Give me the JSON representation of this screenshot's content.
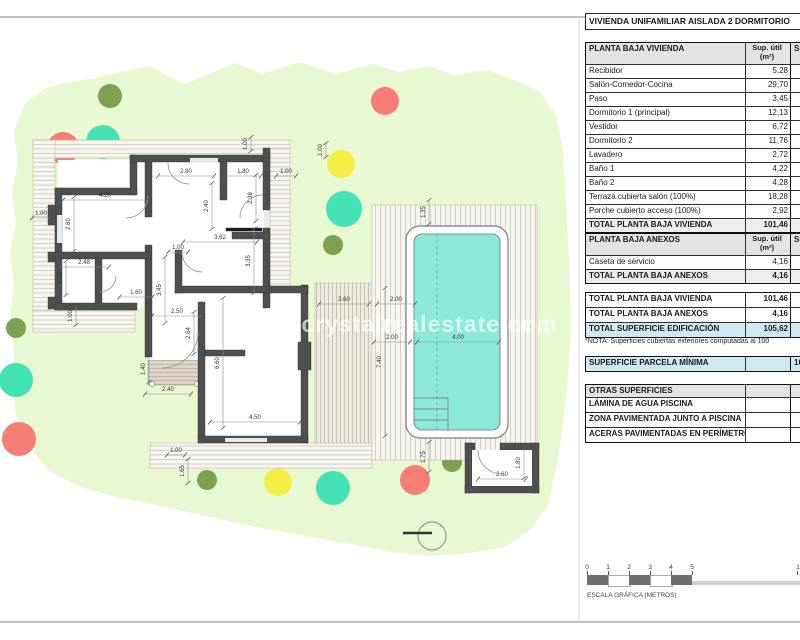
{
  "sheet": {
    "title": "VIVIENDA UNIFAMILIAR AISLADA 2 DORMITORIO",
    "watermark": "www.crystalrealestate.com",
    "nota": "*NOTA: Superficies cubiertas exteriores computadas al 100",
    "colors": {
      "garden": "#e8f8d2",
      "wall": "#4f4f4f",
      "water": "#8ce9da",
      "blue_row": "#cfe9f1",
      "header_row": "#e3e3e3",
      "tree_olive": "#7fa051",
      "tree_red": "#f77d77",
      "tree_teal": "#43e3b5",
      "tree_yellow": "#f2ee45"
    }
  },
  "tables": {
    "vivienda": {
      "rows": [
        {
          "l": "PLANTA BAJA VIVIENDA",
          "v": "Sup. útil\n(m²)",
          "e": "Sup",
          "c": "head"
        },
        {
          "l": "Recibidor",
          "v": "5,28",
          "e": "",
          "c": ""
        },
        {
          "l": "Salón-Comedor-Cocina",
          "v": "29,70",
          "e": "",
          "c": ""
        },
        {
          "l": "Paso",
          "v": "3,45",
          "e": "",
          "c": ""
        },
        {
          "l": "Dormitorio 1 (principal)",
          "v": "12,13",
          "e": "",
          "c": ""
        },
        {
          "l": "Vestidor",
          "v": "6,72",
          "e": "",
          "c": ""
        },
        {
          "l": "Dormitorio 2",
          "v": "11,76",
          "e": "",
          "c": ""
        },
        {
          "l": "Lavadero",
          "v": "2,72",
          "e": "",
          "c": ""
        },
        {
          "l": "Baño 1",
          "v": "4,22",
          "e": "",
          "c": ""
        },
        {
          "l": "Baño 2",
          "v": "4,28",
          "e": "",
          "c": ""
        },
        {
          "l": "Terraza cubierta salón (100%)",
          "v": "18,28",
          "e": "",
          "c": ""
        },
        {
          "l": "Porche cubierto acceso (100%)",
          "v": "2,92",
          "e": "",
          "c": ""
        },
        {
          "l": "TOTAL PLANTA BAJA VIVIENDA",
          "v": "101,46",
          "e": "",
          "c": "total"
        }
      ]
    },
    "anexos": {
      "rows": [
        {
          "l": "PLANTA BAJA ANEXOS",
          "v": "Sup. útil\n(m²)",
          "e": "Sup",
          "c": "head"
        },
        {
          "l": "Caseta de servicio",
          "v": "4,16",
          "e": "",
          "c": ""
        },
        {
          "l": "TOTAL PLANTA BAJA ANEXOS",
          "v": "4,16",
          "e": "",
          "c": "total"
        }
      ]
    },
    "resumen": {
      "rows": [
        {
          "l": "TOTAL PLANTA BAJA VIVIENDA",
          "v": "101,46",
          "e": "",
          "c": "sum"
        },
        {
          "l": "TOTAL PLANTA BAJA ANEXOS",
          "v": "4,16",
          "e": "",
          "c": "sum"
        },
        {
          "l": "TOTAL SUPERFICIE EDIFICACIÓN",
          "v": "105,62",
          "e": "",
          "c": "blue"
        }
      ]
    },
    "parcela": {
      "rows": [
        {
          "l": "SUPERFICIE PARCELA MÍNIMA",
          "v": "",
          "e": "10",
          "c": "blue"
        }
      ]
    },
    "otras": {
      "rows": [
        {
          "l": "OTRAS SUPERFICIES",
          "v": "",
          "e": "",
          "c": "head2"
        },
        {
          "l": "LÁMINA DE AGUA PISCINA",
          "v": "",
          "e": "",
          "c": "sum"
        },
        {
          "l": "ZONA PAVIMENTADA JUNTO A PISCINA",
          "v": "",
          "e": "",
          "c": "sum"
        },
        {
          "l": "ACERAS PAVIMENTADAS EN PERÍMETRO",
          "v": "",
          "e": "",
          "c": "sum"
        }
      ]
    }
  },
  "scale_bar": {
    "ticks": [
      "0",
      "1",
      "2",
      "3",
      "4",
      "5"
    ],
    "far_tick": "1",
    "caption": "ESCALA GRÁFICA (METROS)"
  },
  "plan": {
    "dimensions": [
      {
        "t": "4.20",
        "x": 105,
        "y": 196,
        "o": "h",
        "len": 84
      },
      {
        "t": "2.80",
        "x": 186,
        "y": 172,
        "o": "h",
        "len": 56
      },
      {
        "t": "1.80",
        "x": 243,
        "y": 172,
        "o": "h",
        "len": 36
      },
      {
        "t": "1.00",
        "x": 286,
        "y": 172,
        "o": "h",
        "len": 20
      },
      {
        "t": "1.00",
        "x": 247,
        "y": 144,
        "o": "v",
        "len": 14
      },
      {
        "t": "1.00",
        "x": 322,
        "y": 150,
        "o": "v",
        "len": 14
      },
      {
        "t": "2.40",
        "x": 208,
        "y": 206,
        "o": "v",
        "len": 46
      },
      {
        "t": "2.38",
        "x": 252,
        "y": 198,
        "o": "v",
        "len": 46
      },
      {
        "t": "2.80",
        "x": 70,
        "y": 224,
        "o": "v",
        "len": 54
      },
      {
        "t": "1.00",
        "x": 41,
        "y": 214,
        "o": "h",
        "len": 18
      },
      {
        "t": "1.00",
        "x": 178,
        "y": 248,
        "o": "h",
        "len": 20
      },
      {
        "t": "3.62",
        "x": 220,
        "y": 238,
        "o": "h",
        "len": 74
      },
      {
        "t": "3.45",
        "x": 161,
        "y": 290,
        "o": "v",
        "len": 66
      },
      {
        "t": "3.35",
        "x": 250,
        "y": 261,
        "o": "v",
        "len": 64
      },
      {
        "t": "2.48",
        "x": 84,
        "y": 263,
        "o": "h",
        "len": 50
      },
      {
        "t": "1.70",
        "x": 62,
        "y": 278,
        "o": "v",
        "len": 34
      },
      {
        "t": "1.60",
        "x": 136,
        "y": 293,
        "o": "h",
        "len": 33
      },
      {
        "t": "1.00",
        "x": 72,
        "y": 316,
        "o": "v",
        "len": 18
      },
      {
        "t": "2.50",
        "x": 177,
        "y": 312,
        "o": "h",
        "len": 50
      },
      {
        "t": "2.64",
        "x": 190,
        "y": 333,
        "o": "v",
        "len": 42
      },
      {
        "t": "1.40",
        "x": 145,
        "y": 369,
        "o": "v",
        "len": 26
      },
      {
        "t": "2.40",
        "x": 168,
        "y": 390,
        "o": "h",
        "len": 46
      },
      {
        "t": "6.60",
        "x": 219,
        "y": 363,
        "o": "v",
        "len": 130
      },
      {
        "t": "4.50",
        "x": 255,
        "y": 418,
        "o": "h",
        "len": 90
      },
      {
        "t": "2.60",
        "x": 344,
        "y": 300,
        "o": "h",
        "len": 50
      },
      {
        "t": "2.00",
        "x": 396,
        "y": 300,
        "o": "h",
        "len": 38
      },
      {
        "t": "7.40",
        "x": 381,
        "y": 362,
        "o": "v",
        "len": 148
      },
      {
        "t": "1.35",
        "x": 425,
        "y": 212,
        "o": "v",
        "len": 24
      },
      {
        "t": "2.00",
        "x": 392,
        "y": 338,
        "o": "h",
        "len": 36
      },
      {
        "t": "4.00",
        "x": 458,
        "y": 338,
        "o": "h",
        "len": 82
      },
      {
        "t": "1.75",
        "x": 425,
        "y": 457,
        "o": "v",
        "len": 30
      },
      {
        "t": "1.00",
        "x": 176,
        "y": 451,
        "o": "h",
        "len": 18
      },
      {
        "t": "1.65",
        "x": 184,
        "y": 471,
        "o": "v",
        "len": 24
      },
      {
        "t": "2.60",
        "x": 502,
        "y": 475,
        "o": "h",
        "len": 48
      },
      {
        "t": "1.80",
        "x": 520,
        "y": 463,
        "o": "v",
        "len": 30
      }
    ],
    "trees": [
      {
        "x": 110,
        "y": 96,
        "r": 12,
        "c": "tree_olive"
      },
      {
        "x": 63,
        "y": 148,
        "r": 16,
        "c": "tree_red"
      },
      {
        "x": 103,
        "y": 142,
        "r": 17,
        "c": "tree_teal"
      },
      {
        "x": 385,
        "y": 101,
        "r": 14,
        "c": "tree_red"
      },
      {
        "x": 341,
        "y": 164,
        "r": 14,
        "c": "tree_yellow"
      },
      {
        "x": 344,
        "y": 209,
        "r": 18,
        "c": "tree_teal"
      },
      {
        "x": 333,
        "y": 245,
        "r": 10,
        "c": "tree_olive"
      },
      {
        "x": 16,
        "y": 328,
        "r": 10,
        "c": "tree_olive"
      },
      {
        "x": 16,
        "y": 380,
        "r": 17,
        "c": "tree_teal"
      },
      {
        "x": 19,
        "y": 439,
        "r": 17,
        "c": "tree_red"
      },
      {
        "x": 207,
        "y": 480,
        "r": 10,
        "c": "tree_olive"
      },
      {
        "x": 278,
        "y": 482,
        "r": 14,
        "c": "tree_yellow"
      },
      {
        "x": 333,
        "y": 488,
        "r": 17,
        "c": "tree_teal"
      },
      {
        "x": 415,
        "y": 480,
        "r": 15,
        "c": "tree_red"
      },
      {
        "x": 452,
        "y": 462,
        "r": 10,
        "c": "tree_olive"
      }
    ]
  }
}
